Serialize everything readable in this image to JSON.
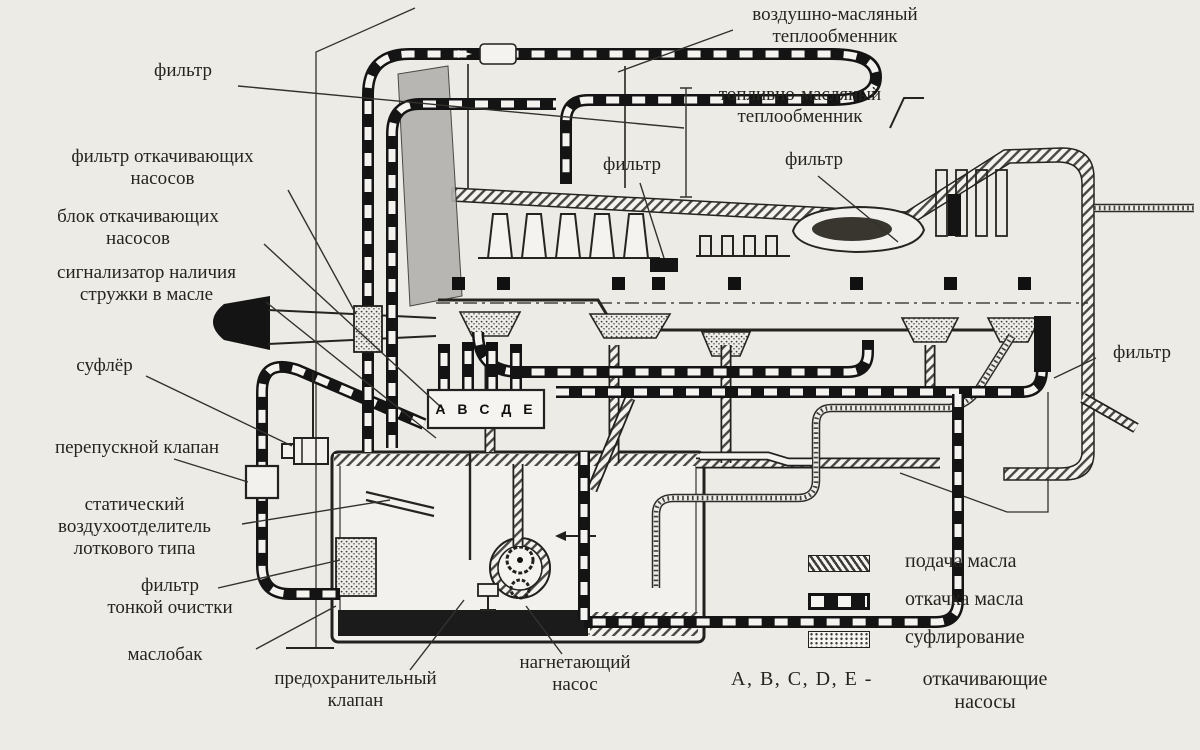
{
  "colors": {
    "paper": "#edebe6",
    "ink": "#26241f"
  },
  "labels": {
    "air_oil_heat_exchanger": "воздушно-масляный\nтеплообменник",
    "fuel_oil_heat_exchanger": "топливно-масляный\nтеплообменник",
    "filter_top_left": "фильтр",
    "filter_front": "фильтр",
    "filter_mid": "фильтр",
    "filter_rear": "фильтр",
    "scavenge_pumps_filter": "фильтр откачивающих\nнасосов",
    "scavenge_pumps_block": "блок откачивающих\nнасосов",
    "chip_detector": "сигнализатор наличия\nстружки в масле",
    "breather": "суфлёр",
    "bypass_valve": "перепускной клапан",
    "static_air_separator": "статический\nвоздухоотделитель\nлоткового типа",
    "fine_filter": "фильтр\nтонкой очистки",
    "oil_tank": "маслобак",
    "safety_valve": "предохранительный\nклапан",
    "pressure_pump": "нагнетающий\nнасос",
    "pump_block_letters": "А В С Д Е"
  },
  "legend": {
    "items": [
      {
        "id": "supply",
        "label": "подача масла"
      },
      {
        "id": "scavenge",
        "label": "откачка масла"
      },
      {
        "id": "breather",
        "label": "суфлирование"
      }
    ],
    "pumps_note": {
      "prefix": "A, B, C, D, E  -",
      "text": "откачивающие\nнасосы"
    }
  }
}
